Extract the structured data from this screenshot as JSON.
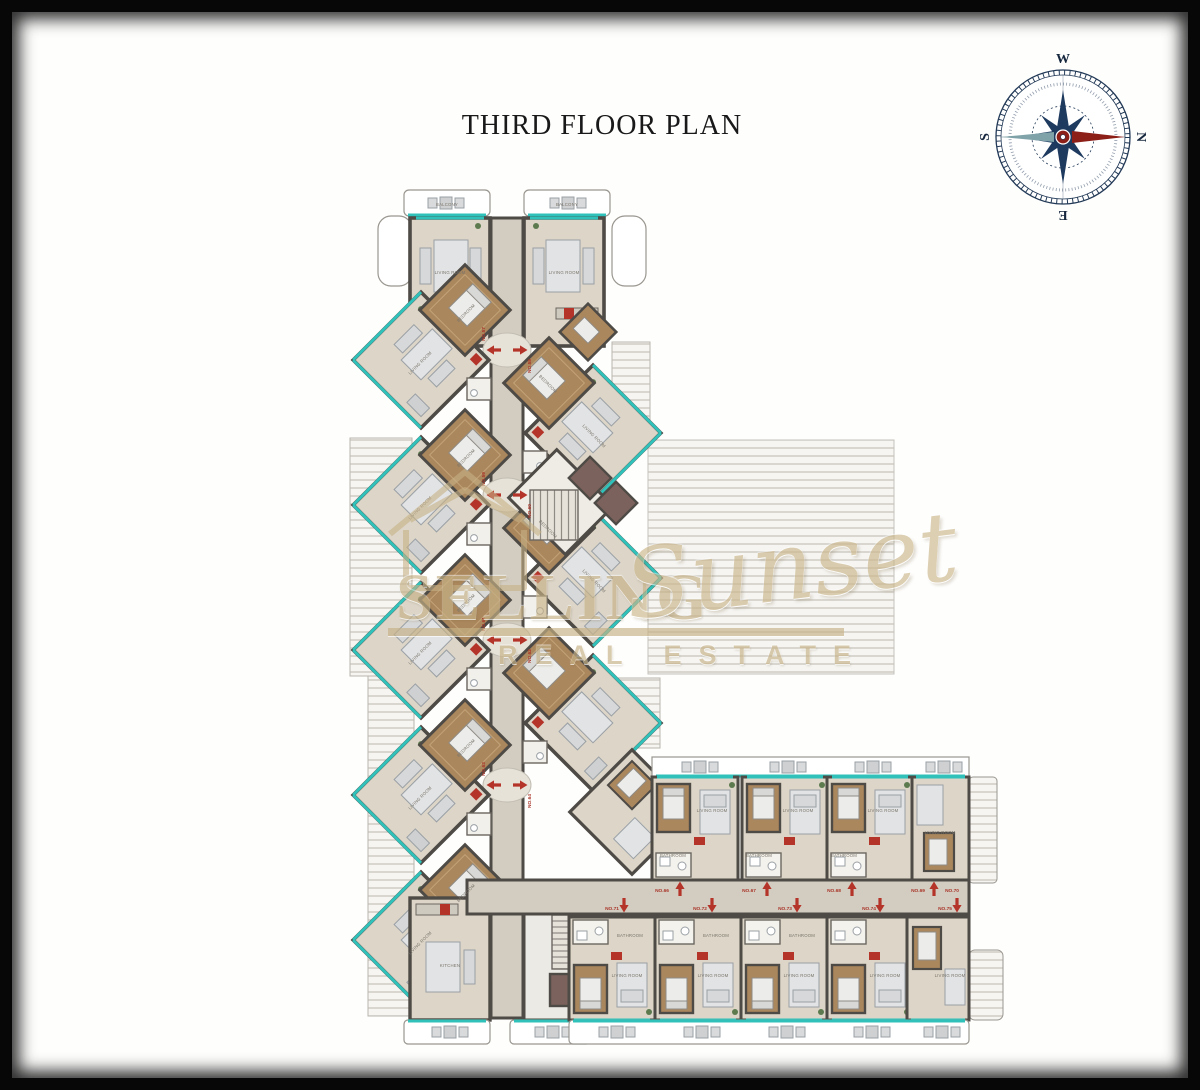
{
  "page": {
    "title": "THIRD FLOOR PLAN"
  },
  "compass": {
    "n": "N",
    "s": "S",
    "e": "E",
    "w": "W"
  },
  "watermark": {
    "brand_left": "SELLING",
    "brand_right": "Sunset",
    "subtitle": "REAL ESTATE"
  },
  "room_labels": {
    "living": "LIVING ROOM",
    "bedroom": "BEDROOM",
    "bathroom": "BATHROOM",
    "balcony": "BALCONY",
    "kitchen": "KITCHEN"
  },
  "corridor_units_top": [
    "NO.66",
    "NO.67",
    "NO.68",
    "NO.69",
    "NO.70"
  ],
  "corridor_units_bottom": [
    "NO.71",
    "NO.72",
    "NO.73",
    "NO.74",
    "NO.75"
  ],
  "spine_units": [
    [
      "NO.57",
      "NO.58"
    ],
    [
      "NO.59",
      "NO.60"
    ],
    [
      "NO.61",
      "NO.62"
    ],
    [
      "NO.63",
      "NO.64"
    ]
  ],
  "colors": {
    "wall": "#4e4a45",
    "floor": "#dcd5c8",
    "corridor": "#d3cdc1",
    "wood_floor": "#ab875d",
    "window_teal": "#2fc1ba",
    "entry_arrow_red": "#b5342a",
    "compass_navy": "#1e3a5f",
    "compass_needle_red": "#8c1f18",
    "watermark_beige": "#c7b286"
  }
}
